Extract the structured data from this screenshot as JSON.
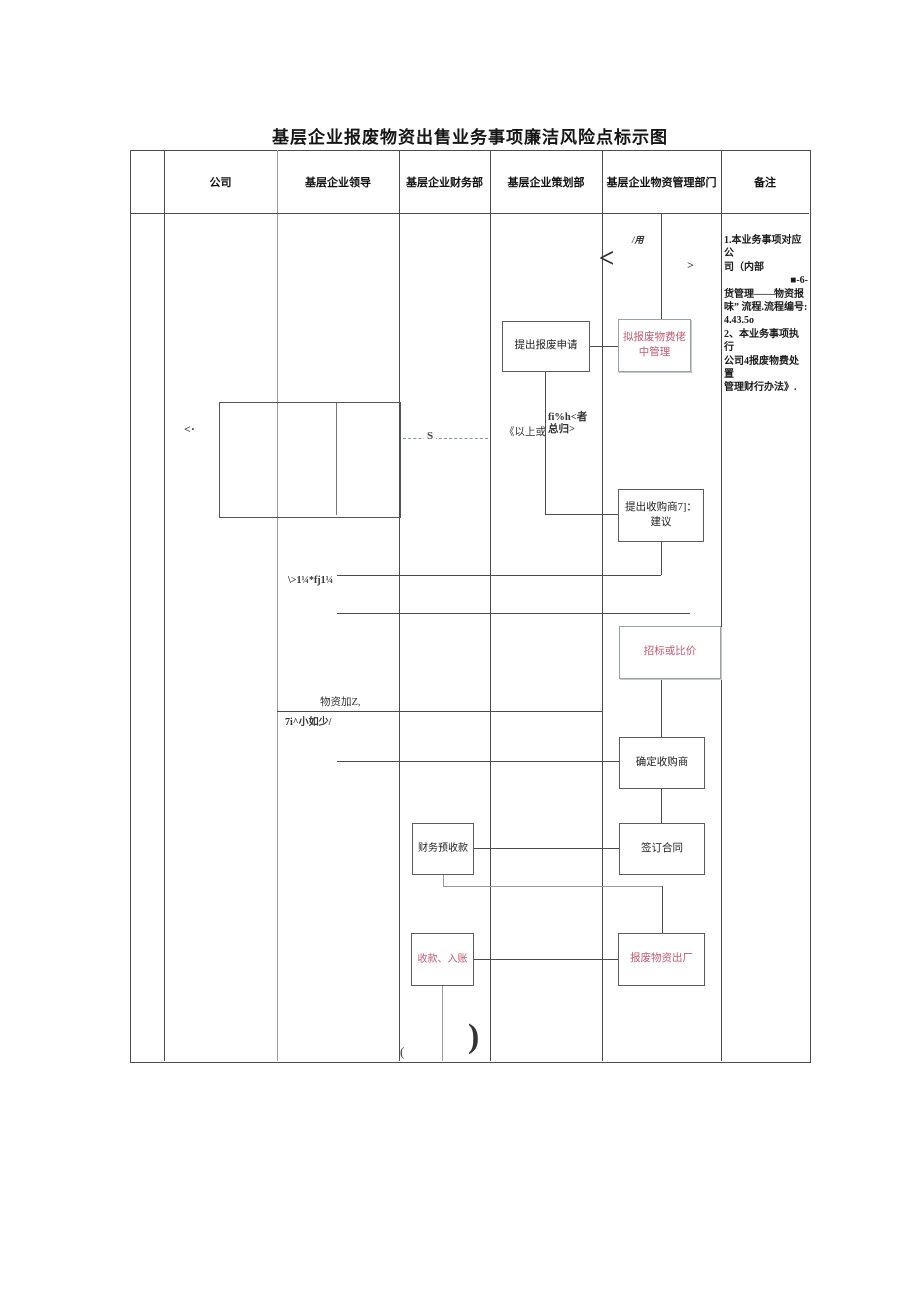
{
  "page_title": "基层企业报废物资出售业务事项廉洁风险点标示图",
  "table": {
    "headers": [
      "公司",
      "基层企业领导",
      "基层企业财务部",
      "基层企业策划部",
      "基层企业物资管理部门",
      "备注"
    ]
  },
  "flow": {
    "boxes": {
      "central_mgmt": "拟报废物费佬中管理",
      "scrap_apply": "提出报废申请",
      "buyer_suggest": "提出收购商7]：建议",
      "bidding": "招标或比价",
      "buyer_confirm": "确定收购商",
      "sign_contract": "签订合同",
      "finance_precollect": "财务预收款",
      "collect_book": "收款、入账",
      "scrap_out": "报废物资出厂"
    },
    "annotations": {
      "slash_yong": "/用",
      "big_lt": "<",
      "small_gt": ">",
      "lt_dot": "<·",
      "s_mark": "S",
      "yishang": "《以上或",
      "zongzhe": "fi%h<者总归>",
      "garble_approve": "\\>1¼*fj1¼",
      "wuzi_jia": "物资加Z,",
      "garble_small": "7i^小如少/",
      "paren_open": "(",
      "paren_close": ")"
    }
  },
  "notes": {
    "lines": [
      "1.本业务事项对应公",
      "司（内部",
      "■-6-",
      "货管理——物资报",
      "味” 流程.流程编号:",
      "4.43.5o",
      "2、本业务事项执行",
      "公司4报废物费处置",
      "管理财行办法》."
    ]
  },
  "colors": {
    "risk_text": "#c25a70",
    "grid": "#4c4c4c"
  }
}
